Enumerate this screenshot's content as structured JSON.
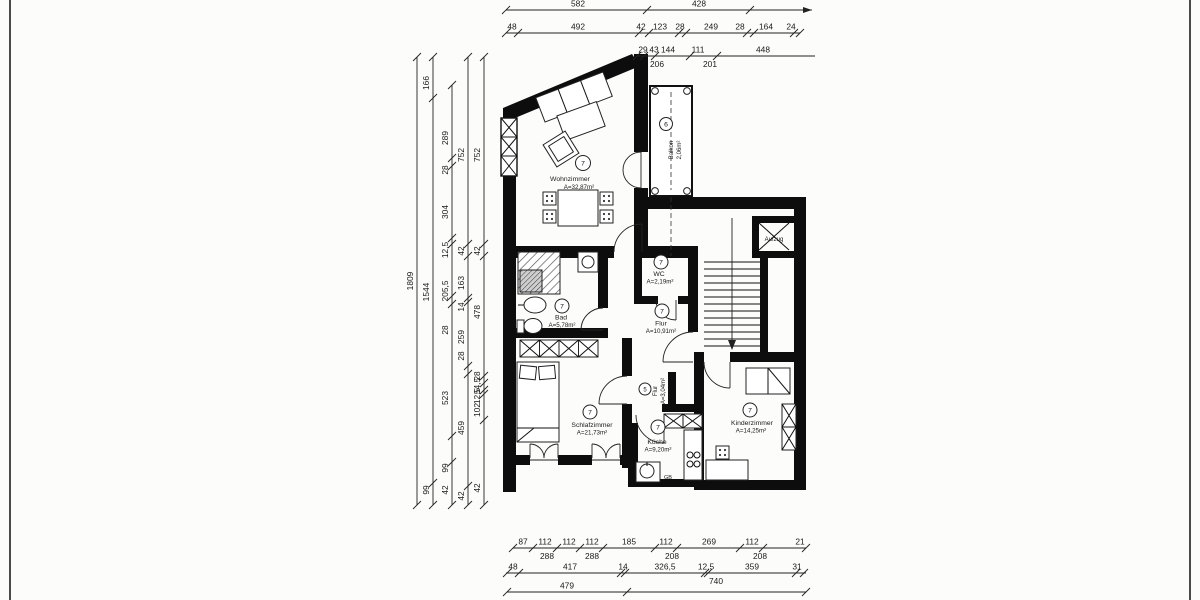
{
  "drawing": {
    "type": "floor-plan",
    "unit": "cm",
    "rooms": [
      {
        "number": "7",
        "name": "Wohnzimmer",
        "area": "A=32,87m²"
      },
      {
        "number": "6",
        "name": "Balkon",
        "area": "2,06m²"
      },
      {
        "number": "7",
        "name": "WC",
        "area": "A=2,19m²"
      },
      {
        "number": "7",
        "name": "Bad",
        "area": "A=5,78m²"
      },
      {
        "number": "7",
        "name": "Flur",
        "area": "A=10,91m²"
      },
      {
        "number": "7",
        "name": "Schlafzimmer",
        "area": "A=21,73m²"
      },
      {
        "number": "5",
        "name": "Flur",
        "area": "A=3,04m²"
      },
      {
        "number": "7",
        "name": "Küche",
        "area": "A=9,20m²"
      },
      {
        "number": "7",
        "name": "Kinderzimmer",
        "area": "A=14,25m²"
      },
      {
        "name": "Aufzug"
      }
    ],
    "labels": {
      "gb": "GB"
    },
    "dim_rows_top": [
      {
        "y": 10,
        "x1": 506,
        "x2": 812,
        "arrow_end": true,
        "ticks": [
          506,
          647,
          750
        ],
        "labels": [
          {
            "v": "582",
            "x": 578
          },
          {
            "v": "428",
            "x": 699
          }
        ]
      },
      {
        "y": 33,
        "x1": 506,
        "x2": 800,
        "ticks": [
          506,
          518,
          639,
          649,
          679,
          686,
          747,
          754,
          794,
          800
        ],
        "labels": [
          {
            "v": "48",
            "x": 512
          },
          {
            "v": "492",
            "x": 578
          },
          {
            "v": "42",
            "x": 641
          },
          {
            "v": "123",
            "x": 660
          },
          {
            "v": "28",
            "x": 680
          },
          {
            "v": "249",
            "x": 711
          },
          {
            "v": "28",
            "x": 740
          },
          {
            "v": "164",
            "x": 766
          },
          {
            "v": "24",
            "x": 791
          }
        ]
      },
      {
        "y": 56,
        "x1": 637,
        "x2": 815,
        "ticks": [
          637,
          644,
          655,
          690,
          717
        ],
        "labels": [
          {
            "v": "29",
            "x": 643
          },
          {
            "v": "43",
            "x": 654
          },
          {
            "v": "144",
            "x": 668
          },
          {
            "v": "111",
            "x": 698
          },
          {
            "v": "448",
            "x": 763
          }
        ],
        "labels_below": [
          {
            "v": "206",
            "x": 657
          },
          {
            "v": "201",
            "x": 710
          }
        ]
      }
    ],
    "dim_cols_left": [
      {
        "x": 417,
        "ticks": [
          57,
          505
        ],
        "labels": [
          {
            "v": "1809",
            "y": 281
          }
        ]
      },
      {
        "x": 433,
        "ticks": [
          57,
          98,
          483,
          505
        ],
        "labels": [
          {
            "v": "166",
            "y": 83
          },
          {
            "v": "1544",
            "y": 292
          },
          {
            "v": "99",
            "y": 490
          }
        ]
      },
      {
        "x": 452,
        "ticks": [
          85,
          158,
          166,
          238,
          244,
          296,
          304,
          436,
          462,
          505
        ],
        "labels": [
          {
            "v": "289",
            "y": 138
          },
          {
            "v": "28",
            "y": 170
          },
          {
            "v": "304",
            "y": 212
          },
          {
            "v": "12,5",
            "y": 250
          },
          {
            "v": "205,5",
            "y": 291
          },
          {
            "v": "28",
            "y": 330
          },
          {
            "v": "523",
            "y": 398
          },
          {
            "v": "99",
            "y": 468
          },
          {
            "v": "42",
            "y": 490
          }
        ]
      },
      {
        "x": 468,
        "ticks": [
          57,
          244,
          256,
          298,
          302,
          366,
          374,
          486,
          505
        ],
        "labels": [
          {
            "v": "752",
            "y": 155
          },
          {
            "v": "42",
            "y": 251
          },
          {
            "v": "163",
            "y": 283
          },
          {
            "v": "14",
            "y": 307
          },
          {
            "v": "259",
            "y": 337
          },
          {
            "v": "28",
            "y": 356
          },
          {
            "v": "459",
            "y": 428
          },
          {
            "v": "42",
            "y": 496
          }
        ]
      },
      {
        "x": 484,
        "ticks": [
          57,
          244,
          256,
          376,
          383,
          390,
          394,
          420,
          505
        ],
        "labels": [
          {
            "v": "752",
            "y": 155
          },
          {
            "v": "42",
            "y": 251
          },
          {
            "v": "478",
            "y": 312
          },
          {
            "v": "28",
            "y": 376
          },
          {
            "v": "54,5",
            "y": 386
          },
          {
            "v": "12,5",
            "y": 396
          },
          {
            "v": "102",
            "y": 410
          },
          {
            "v": "42",
            "y": 488
          }
        ]
      }
    ],
    "dim_rows_bottom": [
      {
        "y": 548,
        "x1": 513,
        "x2": 806,
        "ticks": [
          513,
          533,
          557,
          580,
          603,
          655,
          677,
          740,
          763,
          806
        ],
        "labels": [
          {
            "v": "87",
            "x": 523
          },
          {
            "v": "112",
            "x": 545
          },
          {
            "v": "112",
            "x": 569
          },
          {
            "v": "112",
            "x": 592
          },
          {
            "v": "185",
            "x": 629
          },
          {
            "v": "112",
            "x": 666
          },
          {
            "v": "269",
            "x": 709
          },
          {
            "v": "112",
            "x": 752
          },
          {
            "v": "21",
            "x": 800
          }
        ],
        "labels_below": [
          {
            "v": "288",
            "x": 547
          },
          {
            "v": "288",
            "x": 592
          },
          {
            "v": "208",
            "x": 672
          },
          {
            "v": "208",
            "x": 760
          }
        ]
      },
      {
        "y": 573,
        "x1": 506,
        "x2": 806,
        "ticks": [
          507,
          519,
          621,
          625,
          705,
          708,
          796,
          804
        ],
        "labels": [
          {
            "v": "48",
            "x": 513
          },
          {
            "v": "417",
            "x": 570
          },
          {
            "v": "14",
            "x": 623
          },
          {
            "v": "326,5",
            "x": 665
          },
          {
            "v": "12,5",
            "x": 706
          },
          {
            "v": "359",
            "x": 752
          },
          {
            "v": "31",
            "x": 797
          }
        ],
        "labels_below": [
          {
            "v": "740",
            "x": 716
          }
        ]
      },
      {
        "y": 592,
        "x1": 507,
        "x2": 806,
        "ticks": [
          507,
          627,
          806
        ],
        "labels": [
          {
            "v": "479",
            "x": 567
          }
        ]
      }
    ]
  }
}
